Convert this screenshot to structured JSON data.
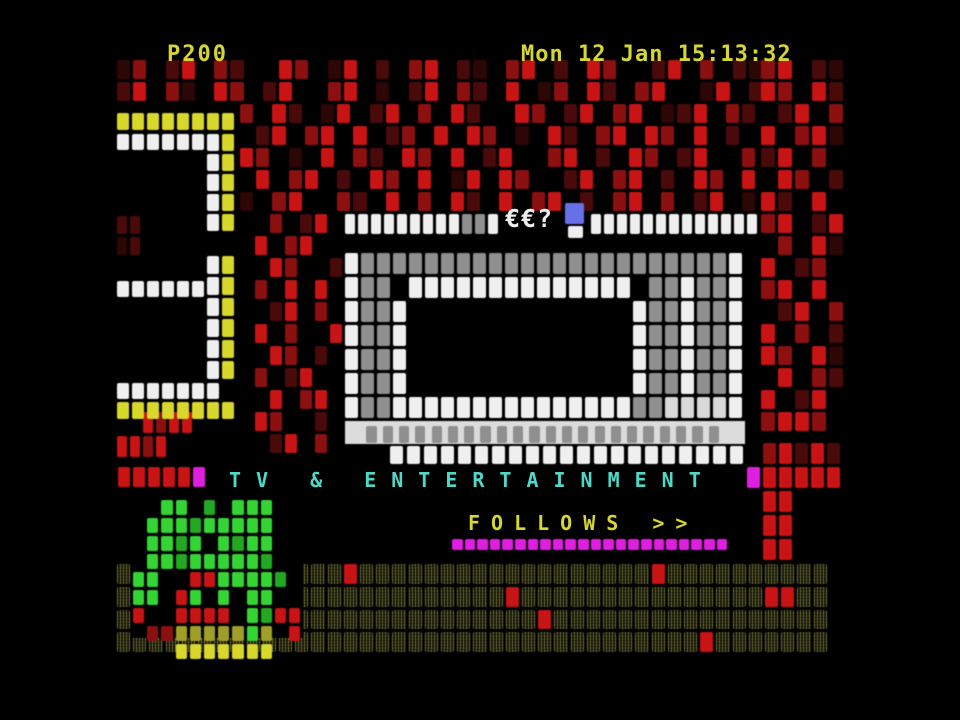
{
  "header": {
    "page": "P200",
    "clock": "Mon 12 Jan 15:13:32"
  },
  "antenna": {
    "glyphs": "€€?"
  },
  "banner": {
    "title": "TV & ENTERTAINMENT"
  },
  "follows": {
    "label": "FOLLOWS >>"
  },
  "colors": {
    "yellow_text": "#d6d630",
    "cyan_text": "#4fd8c8",
    "white_text": "#ededed",
    "background": "#000000"
  },
  "palette": {
    "W": "#efefef",
    "G": "#8f8f8f",
    "L": "#d9d9d9",
    "Y": "#d7d72c",
    "y": "#9f9f28",
    "R": "#c81414",
    "r": "#8c1010",
    "d": "#4a0a0a",
    "x": "#2d0606",
    "M": "#df1fdf",
    "B": "#6671e8",
    "g": "#35d435",
    "e": "#23a823"
  },
  "blocks": [
    {
      "name": "redfield-top",
      "x": 117,
      "y": 60,
      "cw": 16.2,
      "ch": 22,
      "g": 3,
      "rows": [
        "xr.dR.rd..Rr.xR.d.rR.dx.rR.d.Rr..dR.r.dx",
        "dR.rx.Rr.dR..rR.x.dR.rd.R.xr.Rd.rR..xR.d"
      ]
    },
    {
      "name": "redfield-upper",
      "x": 240,
      "y": 104,
      "cw": 16.2,
      "ch": 22,
      "g": 3,
      "rows": [
        "r.Rd.xR.dR.r.Rd..Rr.dR.rR.xdR.rd",
        ".dR.rR.R.dr.R.Rr.x.Rd.rR.Rr.R.d.",
        "Rr.x.R.rd.Rr.R.dR..rR.d.Rr.dR..r",
        ".R.rR.d.Rr.R.xR.Rr..dR.rR.d.Rr.R",
        "x.rR..rd.R.r.Rd.R.rR.d.rR.r.dR.x"
      ]
    },
    {
      "name": "redfield-right",
      "x": 761,
      "y": 60,
      "cw": 17,
      "ch": 22,
      "g": 3,
      "rows": [
        "rR.dx",
        "Rr.Rd",
        ".dR.r",
        "R.rRx",
        "dR.r.",
        ".Rr.d",
        "Rd.R.",
        "rR.dR",
        ".r.Rx",
        "R.dr.",
        "rR.R.",
        ".dR.r",
        "R.r.d",
        "Rr.Rx",
        ".R.rd",
        "R.dR.",
        "rRRr."
      ]
    },
    {
      "name": "redfield-mid",
      "x": 240,
      "y": 214,
      "cw": 15,
      "ch": 22,
      "g": 3,
      "rows": [
        "..r.dR.",
        ".R.rR..",
        "..Rr..d",
        ".r.R.R.",
        "..dR.r.",
        ".R.r..R",
        "..Rr.d.",
        ".r.dR..",
        "..R.rR.",
        ".Rr..d.",
        "..dR.r."
      ]
    },
    {
      "name": "red-left-edge",
      "x": 117,
      "y": 216,
      "cw": 13,
      "ch": 21,
      "g": 3,
      "rows": [
        "dd",
        "xd"
      ]
    },
    {
      "name": "red-left-cluster",
      "x": 117,
      "y": 412,
      "cw": 13,
      "ch": 24,
      "g": 3,
      "rows": [
        "..RrRR.",
        "RRrR..."
      ]
    },
    {
      "name": "digit-top-yellow-bar",
      "x": 117,
      "y": 113,
      "cw": 15,
      "ch": 20,
      "g": 3,
      "rows": [
        "YYYYYYYY"
      ]
    },
    {
      "name": "digit-top-white-bar",
      "x": 117,
      "y": 134,
      "cw": 15,
      "ch": 19,
      "g": 3,
      "rows": [
        "WWWWWW"
      ]
    },
    {
      "name": "digit-top-vertical",
      "x": 207,
      "y": 134,
      "cw": 15,
      "ch": 20,
      "g": 3,
      "rows": [
        "WY",
        "WY",
        "WY",
        "WY",
        "WY"
      ]
    },
    {
      "name": "digit-bottom-vertical",
      "x": 207,
      "y": 256,
      "cw": 15,
      "ch": 21,
      "g": 3,
      "rows": [
        "WY",
        "WY",
        "WY",
        "WY",
        "WY",
        "WY"
      ]
    },
    {
      "name": "digit-mid-white-bar",
      "x": 117,
      "y": 281,
      "cw": 15,
      "ch": 19,
      "g": 3,
      "rows": [
        "WWWWWW"
      ]
    },
    {
      "name": "digit-bottom-white-bar",
      "x": 117,
      "y": 383,
      "cw": 15,
      "ch": 19,
      "g": 3,
      "rows": [
        "WWWWWWW"
      ]
    },
    {
      "name": "digit-bottom-yellow-bar",
      "x": 117,
      "y": 402,
      "cw": 15,
      "ch": 20,
      "g": 3,
      "rows": [
        "YYYYYYYY"
      ]
    },
    {
      "name": "antenna-row-left",
      "x": 345,
      "y": 214,
      "cw": 13,
      "ch": 23,
      "g": 3,
      "rows": [
        "WWWWWWWWWGGW"
      ]
    },
    {
      "name": "antenna-cursor-blue",
      "x": 565,
      "y": 203,
      "cw": 21,
      "ch": 23,
      "g": 2,
      "rows": [
        "B"
      ]
    },
    {
      "name": "antenna-cursor-white",
      "x": 568,
      "y": 226,
      "cw": 17,
      "ch": 14,
      "g": 2,
      "rows": [
        "W"
      ]
    },
    {
      "name": "antenna-row-right",
      "x": 591,
      "y": 214,
      "cw": 13,
      "ch": 23,
      "g": 3,
      "rows": [
        "WWWWWWWWWWWWW"
      ]
    },
    {
      "name": "tv-set",
      "x": 345,
      "y": 253,
      "cw": 16,
      "ch": 24,
      "g": 3,
      "rows": [
        "WGGGGGGGGGGGGGGGGGGGGGGGW",
        "WGG.WWWWWWWWWWWWWW.GGWGGW",
        "WGGW..............WGGWGGW",
        "WGGW..............WGGWGGW",
        "WGGW..............WGGWGGW",
        "WGGW..............WGGWGGW",
        "WGGWWWWWWWWWWWWWWWGGLLLLW"
      ]
    },
    {
      "name": "tv-speaker-strip",
      "x": 345,
      "y": 421,
      "w": 400,
      "h": 23,
      "bg": "#dcdcdc",
      "cw": 16.3,
      "ch": 23,
      "g": 6,
      "pad": 5,
      "rows": [
        ".GGGGGGGGGGGGGGGGGGGGGG."
      ]
    },
    {
      "name": "tv-stand",
      "x": 390,
      "y": 446,
      "cw": 17,
      "ch": 22,
      "g": 4,
      "rows": [
        "WWWWWWWWWWWWWWWWWWWWW"
      ]
    },
    {
      "name": "banner-left-squares",
      "x": 118,
      "y": 467,
      "cw": 15,
      "ch": 23,
      "g": 3,
      "rows": [
        "RRRRRM"
      ]
    },
    {
      "name": "banner-right-squares",
      "x": 747,
      "y": 443,
      "cw": 16,
      "ch": 24,
      "g": 3,
      "rows": [
        ".rRdRd",
        "MRRRRR"
      ]
    },
    {
      "name": "plant-stem",
      "x": 763,
      "y": 491,
      "cw": 16,
      "ch": 24,
      "g": 3,
      "rows": [
        "RR",
        "RR",
        "RR"
      ]
    },
    {
      "name": "follows-strip",
      "x": 452,
      "y": 539,
      "cw": 12.6,
      "ch": 13,
      "g": 2,
      "rows": [
        "MMMMMMMMMMMMMMMMMMMMMM"
      ]
    },
    {
      "name": "dither-band",
      "x": 117,
      "y": 564,
      "cw": 16.2,
      "ch": 22.8,
      "g": 3,
      "rows": [
        "OOOOOOOOOOOOOOROOOOOOOOOOOOOOOOOOROOOOOOOOOO",
        "OOOOOOOOOOOOOOOOOOOOOOOOROOOOOOOOOOOOOOORROO",
        "OOOOOOOOOROOOOOOOOOOOOOOOOROOOOOOOOOOOOOOOOO",
        "OOOOOOOOOOOOOOOOOOOOOOOOOOOOOOOOOOOOROOOOOOO"
      ]
    },
    {
      "name": "bush-backdrop",
      "x": 131,
      "y": 496,
      "w": 172,
      "h": 142,
      "bg": "#000000",
      "rows": []
    },
    {
      "name": "bush",
      "x": 133,
      "y": 500,
      "cw": 14.2,
      "ch": 18,
      "g": 3,
      "rows": [
        "..gg.e.ggg..",
        ".gggeggggg..",
        ".ggeg.gegg..",
        ".ggeggggge..",
        "gg..RRgggge.",
        "gg.Rg.g.gg..",
        "R..RRRR.geRR",
        ".rryyyyygy.R",
        "...YYYYYYY.."
      ]
    }
  ]
}
